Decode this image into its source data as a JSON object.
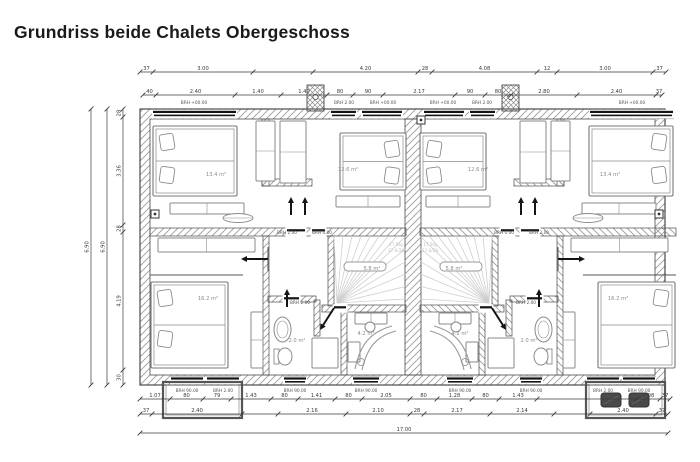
{
  "title": "Grundriss beide Chalets Obergeschoss",
  "colors": {
    "ink": "#4a4a4a",
    "hatch": "#9c9c9c",
    "furniture": "#8a8a8a",
    "light": "#cfcfcf",
    "black": "#141414",
    "dim_text": "#3a3a3a",
    "room_label": "#8c8c8c",
    "faint": "#bdbdbd",
    "title": "#1a1a1a",
    "bg": "#ffffff"
  },
  "plan": {
    "mirror_axis": 413,
    "outer": {
      "x": 140,
      "y": 109,
      "w": 525,
      "h": 276
    },
    "wall_thickness": 10,
    "party_wall": {
      "x": 405,
      "y": 119,
      "w": 16,
      "h": 256
    },
    "chimney": {
      "x": 307,
      "y": 85,
      "w": 17,
      "h": 26
    },
    "walls": [
      [
        150,
        228,
        256,
        8
      ],
      [
        262,
        119,
        7,
        67
      ],
      [
        262,
        179,
        50,
        7
      ],
      [
        263,
        236,
        6,
        139
      ],
      [
        328,
        236,
        6,
        70
      ],
      [
        322,
        305,
        84,
        7
      ],
      [
        341,
        312,
        6,
        63
      ],
      [
        268,
        296,
        48,
        6
      ],
      [
        314,
        300,
        6,
        36
      ]
    ],
    "gaps": [
      [
        286,
        228,
        20,
        8
      ],
      [
        311,
        228,
        15,
        8
      ],
      [
        333,
        305,
        14,
        7
      ],
      [
        283,
        296,
        17,
        6
      ]
    ],
    "thin_lines": [
      [
        150,
        275,
        243,
        275
      ],
      [
        268,
        247,
        268,
        271
      ]
    ],
    "windows_top": [
      [
        152,
        85
      ],
      [
        330,
        27
      ],
      [
        361,
        42
      ]
    ],
    "windows_bottom": [
      [
        170,
        34
      ],
      [
        206,
        34
      ],
      [
        283,
        24
      ],
      [
        352,
        28
      ]
    ],
    "beds": [
      {
        "x": 153,
        "y": 126,
        "w": 84,
        "h": 70,
        "head": "left"
      },
      {
        "x": 340,
        "y": 133,
        "w": 66,
        "h": 57,
        "head": "right"
      },
      {
        "x": 151,
        "y": 282,
        "w": 77,
        "h": 86,
        "head": "left"
      }
    ],
    "furniture": [
      {
        "x": 256,
        "y": 121,
        "w": 19,
        "h": 60,
        "div": "h"
      },
      {
        "x": 280,
        "y": 121,
        "w": 26,
        "h": 62,
        "div": "h"
      },
      {
        "x": 170,
        "y": 203,
        "w": 74,
        "h": 11,
        "div": "v"
      },
      {
        "x": 158,
        "y": 238,
        "w": 97,
        "h": 14,
        "div": "v"
      },
      {
        "x": 251,
        "y": 312,
        "w": 12,
        "h": 56,
        "div": "h"
      },
      {
        "x": 336,
        "y": 196,
        "w": 64,
        "h": 11,
        "div": "v"
      },
      {
        "x": 355,
        "y": 313,
        "w": 32,
        "h": 11,
        "div": "v"
      },
      {
        "x": 312,
        "y": 338,
        "w": 26,
        "h": 30,
        "div": "none"
      },
      {
        "x": 348,
        "y": 342,
        "w": 12,
        "h": 20,
        "div": "none"
      }
    ],
    "oval_table": {
      "cx": 238,
      "cy": 218,
      "rx": 15,
      "ry": 4.5
    },
    "chair": {
      "cx": 370,
      "cy": 327,
      "r": 5
    },
    "lounger": {
      "x": 355,
      "y": 369
    },
    "sink": {
      "x": 274,
      "y": 317,
      "w": 17,
      "h": 25
    },
    "toilet": {
      "x": 274,
      "y": 346,
      "w": 16,
      "h": 21
    },
    "stairs": {
      "x": 334,
      "y": 236,
      "w": 72,
      "h": 69,
      "cx": 337,
      "cy": 303
    },
    "handrail": {
      "x": 344,
      "y": 262,
      "w": 42,
      "h": 9
    },
    "arrows": [
      [
        291,
        215,
        291,
        197
      ],
      [
        305,
        215,
        305,
        197
      ],
      [
        268,
        259,
        241,
        259
      ],
      [
        287,
        307,
        287,
        289
      ],
      [
        334,
        308,
        320,
        330
      ]
    ],
    "vents": [
      [
        151,
        210
      ],
      [
        655,
        210
      ],
      [
        417,
        116
      ]
    ],
    "balcony_left": {
      "x": 163,
      "y": 382,
      "w": 79,
      "h": 36
    },
    "balcony_right": {
      "x": 586,
      "y": 382,
      "w": 79,
      "h": 36
    },
    "balcony_furniture": [
      {
        "x": 601,
        "y": 393,
        "w": 20,
        "h": 14
      },
      {
        "x": 629,
        "y": 393,
        "w": 20,
        "h": 14
      }
    ]
  },
  "labels": {
    "window_labels": [
      {
        "x": 194,
        "y": 104,
        "t": "BRH +00.00"
      },
      {
        "x": 344,
        "y": 104,
        "t": "BRH 2.00"
      },
      {
        "x": 383,
        "y": 104,
        "t": "BRH +00.00"
      },
      {
        "x": 187,
        "y": 392,
        "t": "BRH 90.00"
      },
      {
        "x": 223,
        "y": 392,
        "t": "BRH 2.00"
      },
      {
        "x": 295,
        "y": 392,
        "t": "BRH 90.00"
      },
      {
        "x": 366,
        "y": 392,
        "t": "BRH 90.00"
      },
      {
        "x": 287,
        "y": 234,
        "t": "BRH 2.00"
      },
      {
        "x": 322,
        "y": 234,
        "t": "BRH 0.00"
      },
      {
        "x": 300,
        "y": 304,
        "t": "BRH 2.00"
      }
    ],
    "room_labels": [
      {
        "x": 216,
        "y": 176,
        "t": "13.4 m²"
      },
      {
        "x": 348,
        "y": 171,
        "t": "12.6 m²"
      },
      {
        "x": 208,
        "y": 300,
        "t": "16.2 m²"
      },
      {
        "x": 297,
        "y": 342,
        "t": "2.0 m²"
      },
      {
        "x": 366,
        "y": 335,
        "t": "4.2 m²"
      },
      {
        "x": 372,
        "y": 270,
        "t": "5.8 m²"
      }
    ],
    "faint_labels": [
      {
        "x": 396,
        "y": 246,
        "t": "17 Stg"
      },
      {
        "x": 396,
        "y": 252,
        "t": "17,6/28"
      }
    ]
  },
  "dimensions": {
    "top_row1": {
      "y": 72,
      "x0": 140,
      "segs": [
        [
          13,
          "37"
        ],
        [
          100,
          "3.00"
        ],
        [
          60,
          ""
        ],
        [
          105,
          "4.20"
        ],
        [
          14,
          "28"
        ],
        [
          105,
          "4.08"
        ],
        [
          20,
          "12"
        ],
        [
          96,
          "3.00"
        ],
        [
          13,
          "37"
        ]
      ]
    },
    "top_row2": {
      "y": 95,
      "x0": 143,
      "segs": [
        [
          13,
          "40"
        ],
        [
          79,
          "2.40"
        ],
        [
          46,
          "1.40"
        ],
        [
          46,
          "1.40"
        ],
        [
          26,
          "80"
        ],
        [
          30,
          "90"
        ],
        [
          72,
          "2.17"
        ],
        [
          30,
          "90"
        ],
        [
          26,
          "80"
        ],
        [
          66,
          "2.80"
        ],
        [
          79,
          "2.40"
        ],
        [
          6,
          "37"
        ]
      ]
    },
    "left_cols": [
      {
        "x": 91,
        "y0": 109,
        "segs": [
          [
            276,
            "6.90"
          ]
        ]
      },
      {
        "x": 107,
        "y0": 109,
        "segs": [
          [
            276,
            "6.90"
          ]
        ]
      },
      {
        "x": 123,
        "y0": 109,
        "segs": [
          [
            8,
            "28"
          ],
          [
            108,
            "3.36"
          ],
          [
            7,
            "28"
          ],
          [
            138,
            "4.19"
          ],
          [
            15,
            "30"
          ]
        ]
      }
    ],
    "bottom_row1": {
      "y": 399,
      "x0": 140,
      "segs": [
        [
          30,
          "1.07"
        ],
        [
          33,
          "80"
        ],
        [
          28,
          "79"
        ],
        [
          40,
          "1.43"
        ],
        [
          27,
          "80"
        ],
        [
          37,
          "1.41"
        ],
        [
          27,
          "80"
        ],
        [
          48,
          "2.05"
        ],
        [
          27,
          "80"
        ],
        [
          35,
          "1.28"
        ],
        [
          27,
          "80"
        ],
        [
          38,
          "1.43"
        ],
        [
          100,
          ""
        ],
        [
          23,
          "1.08"
        ],
        [
          10,
          "37"
        ]
      ]
    },
    "bottom_row2": {
      "y": 414,
      "x0": 140,
      "segs": [
        [
          12,
          "37"
        ],
        [
          90,
          "2.40"
        ],
        [
          36,
          ""
        ],
        [
          68,
          "2.16"
        ],
        [
          64,
          "2.10"
        ],
        [
          14,
          "28"
        ],
        [
          66,
          "2.17"
        ],
        [
          64,
          "2.14"
        ],
        [
          36,
          ""
        ],
        [
          66,
          "2.40"
        ],
        [
          12,
          "37"
        ]
      ]
    },
    "bottom_row3": {
      "y": 433,
      "x0": 140,
      "segs": [
        [
          528,
          "17.00"
        ]
      ]
    }
  }
}
